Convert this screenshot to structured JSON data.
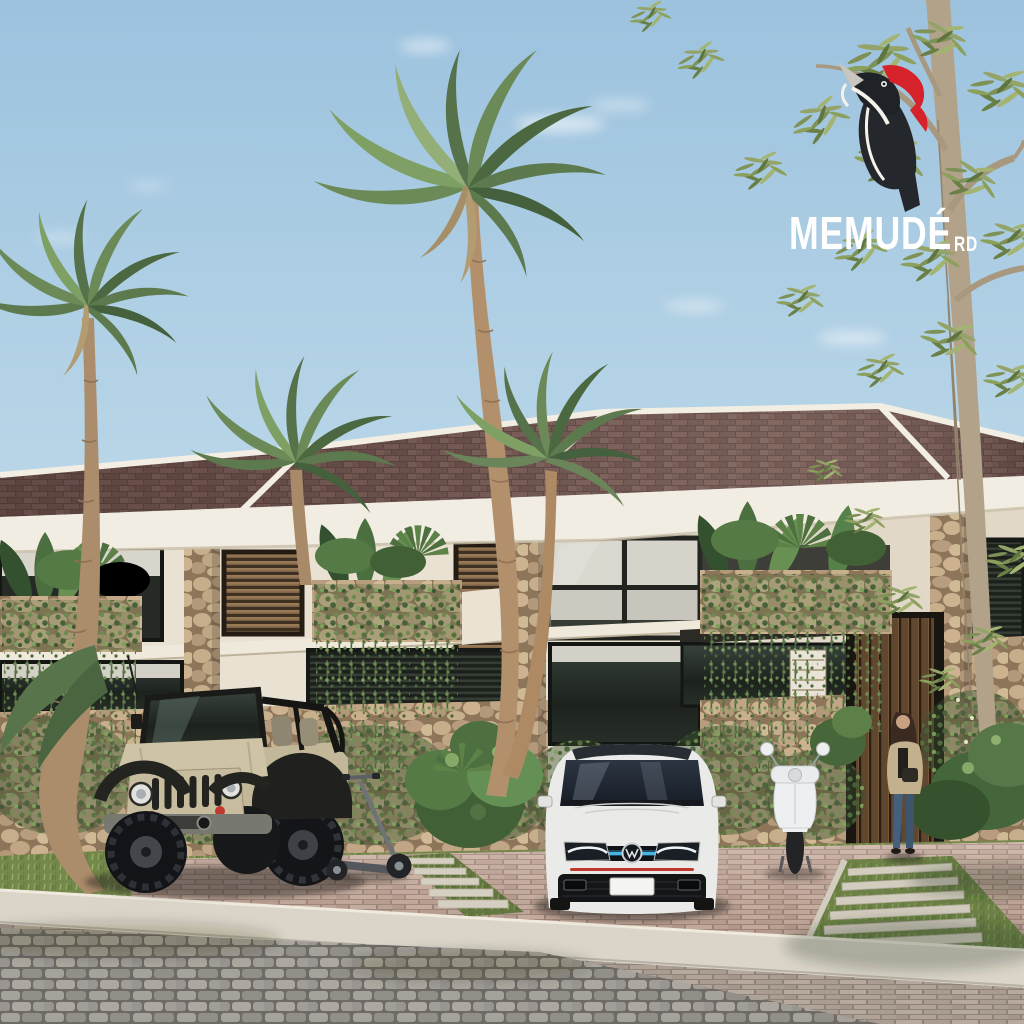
{
  "scene": {
    "type": "3d architectural rendering",
    "description": "Street-level view of a modern two-storey tropical townhouse row: brown shingle gable roofs with white trim, cream stucco walls, coral-stone planters with tropical plants and hanging vines, wood-louver windows. A tan open-top jeep, an electric kick scooter, a white sedan and a white scooter are parked on brick-paver pads; a woman stands by a wood-slat entry door. Coconut palms and a slender tree frame the scene under a pale blue sky."
  },
  "logo": {
    "brand": "MEMUDÉ",
    "suffix": "RD",
    "icon": "woodpecker-icon",
    "text_color": "#ffffff",
    "crest_color": "#d6232b",
    "body_color": "#24272c"
  },
  "palette": {
    "sky_top": "#9cc2de",
    "sky_horizon": "#d7e9f2",
    "roof_shingle": "#755954",
    "roof_trim": "#f3eee3",
    "wall_cream": "#e9e1d2",
    "stone_clad": "#c3ab8c",
    "wood_louver": "#7b6247",
    "glass_dark": "#232a24",
    "foliage_green": "#5d7a4f",
    "palm_trunk": "#ab8c6b",
    "paver_pink": "#c2a495",
    "curb_concrete": "#dbd5c9",
    "road_cobble": "#a19d98",
    "grass": "#74884b",
    "jeep_tan": "#cfc3a6",
    "car_white": "#eaeae8",
    "vespa_white": "#edeff0",
    "led_blue": "#45b5e4",
    "accent_red": "#c0392e"
  },
  "objects": {
    "vehicles": [
      "tan open-top jeep",
      "electric kick scooter",
      "white sedan",
      "white vespa scooter"
    ],
    "people": [
      "woman standing at entry door"
    ],
    "vegetation": [
      "coconut palm left",
      "tall coconut palm center",
      "balcony planter plants",
      "hanging vines",
      "shrubs between parking pads",
      "slender-leaf tree right"
    ],
    "hardscape": [
      "brick paver driveway",
      "concrete curb",
      "cobblestone road",
      "stepping-stone walkway"
    ]
  }
}
